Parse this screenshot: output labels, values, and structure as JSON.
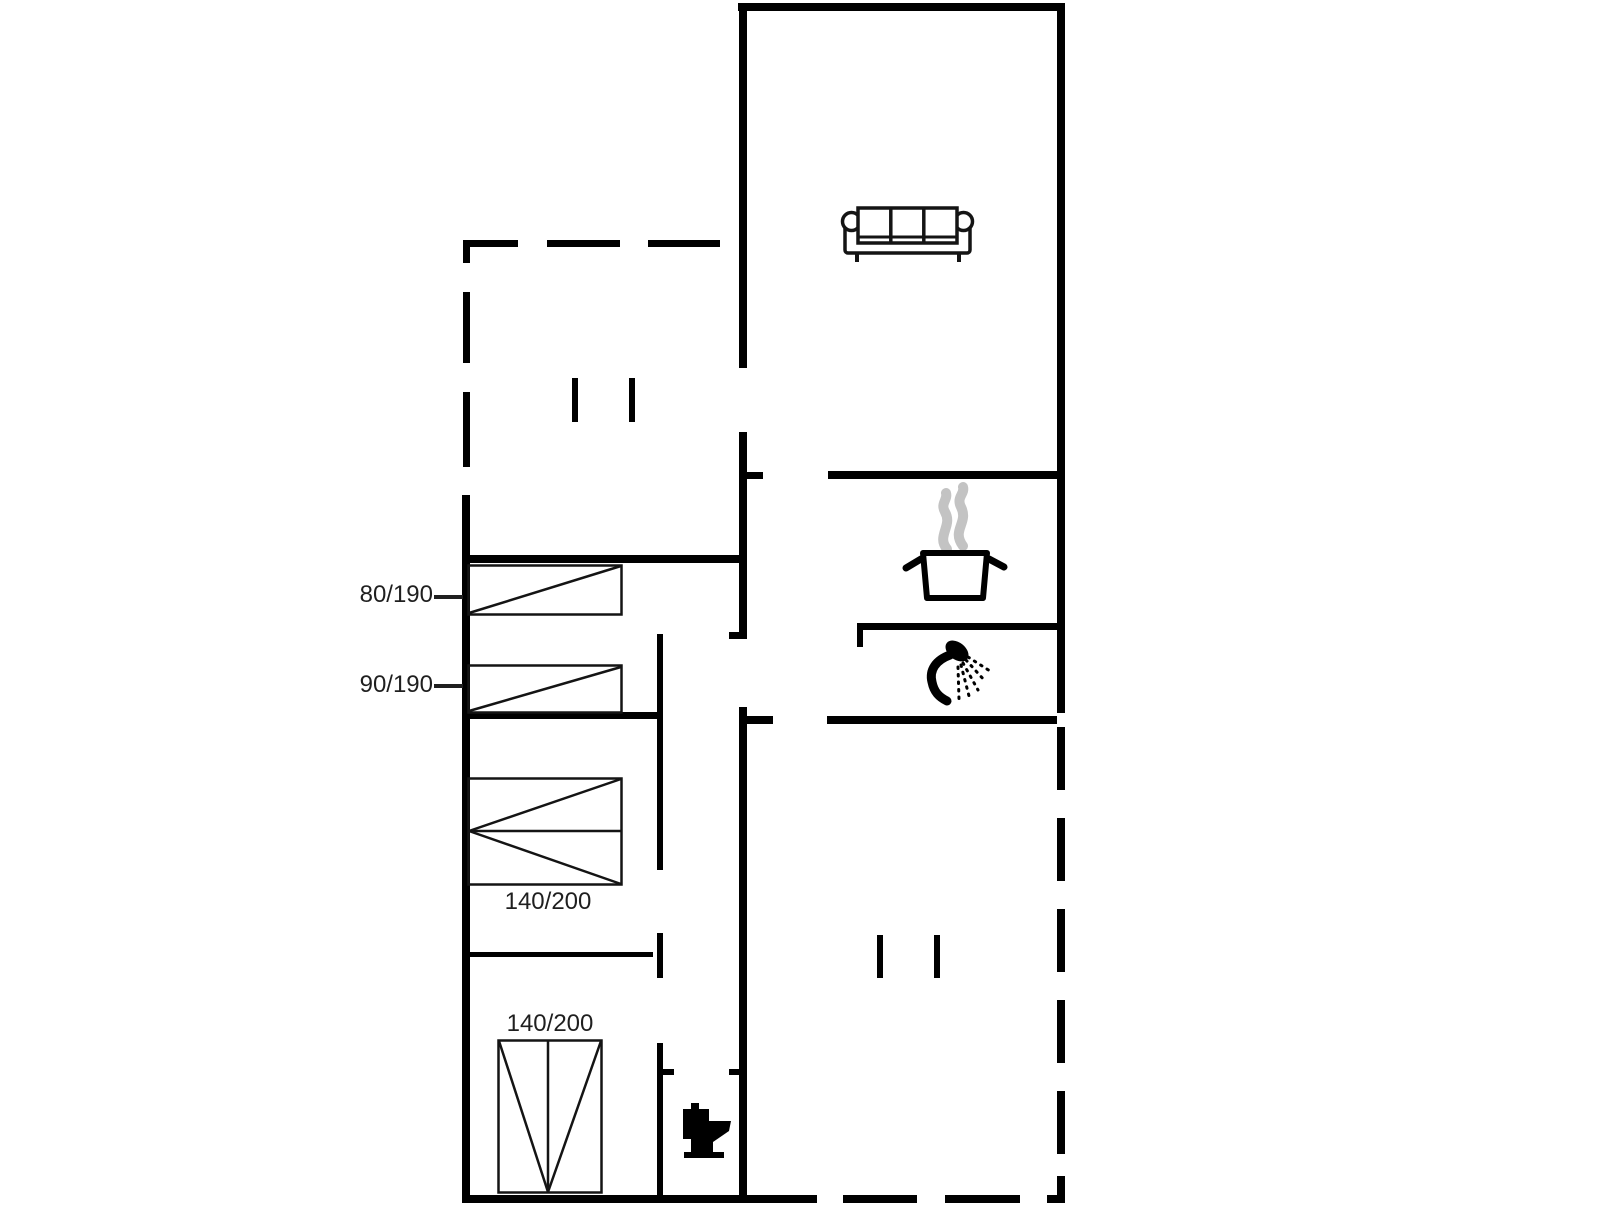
{
  "plan": {
    "type": "holiday-house floor plan",
    "labels": {
      "bed_80_190": "80/190",
      "bed_90_190": "90/190",
      "bed_140_200_middle": "140/200",
      "bed_140_200_bottom": "140/200"
    },
    "icons": {
      "living_room": "sofa-icon",
      "kitchen": "cooking-pot-with-steam-icon",
      "bathroom": "shower-icon",
      "wc": "toilet-icon",
      "openings": "window-marker-icon",
      "terrace_outline": "dashed-boundary"
    },
    "colors": {
      "wall": "#000000",
      "label_text": "#1f1f1f",
      "steam": "#c3c3c3",
      "background": "#ffffff"
    }
  }
}
